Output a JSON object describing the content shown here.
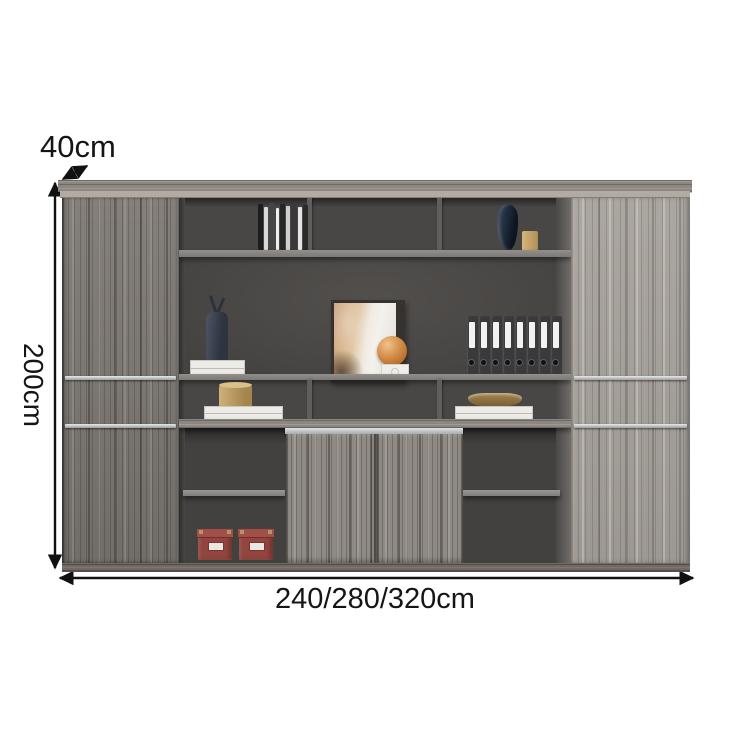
{
  "annotations": {
    "depth_label": "40cm",
    "height_label": "200cm",
    "width_label": "240/280/320cm",
    "line_color": "#111111"
  },
  "cabinet": {
    "description": "wood-grain office wall cabinet with open shelving, sliding doors and side wardrobes",
    "colors": {
      "wood_mid": "#8f8a84",
      "wood_dark": "#7e7973",
      "wood_light": "#a6a19b",
      "interior_back": "#494745",
      "shelf_gray": "#8a8784",
      "handle_silver": "#c6c7c8",
      "box_red": "#93443e",
      "binder_dark": "#3a3a3d",
      "sphere_orange": "#d18a44",
      "canister_gold": "#b3915a",
      "vase_navy": "#16202e"
    },
    "decor": {
      "top_left_compartment": "stack of books",
      "top_right_compartment": "dark vase and gold candle",
      "display_left": "dark sculpture on white books",
      "display_center": "abstract art print, orange sphere on white stand",
      "display_right": "row of binders",
      "binder_count": 8,
      "middle_left": "gold canister on white books",
      "middle_right": "bronze bowl on white books",
      "bottom_left": "two red storage boxes"
    }
  }
}
